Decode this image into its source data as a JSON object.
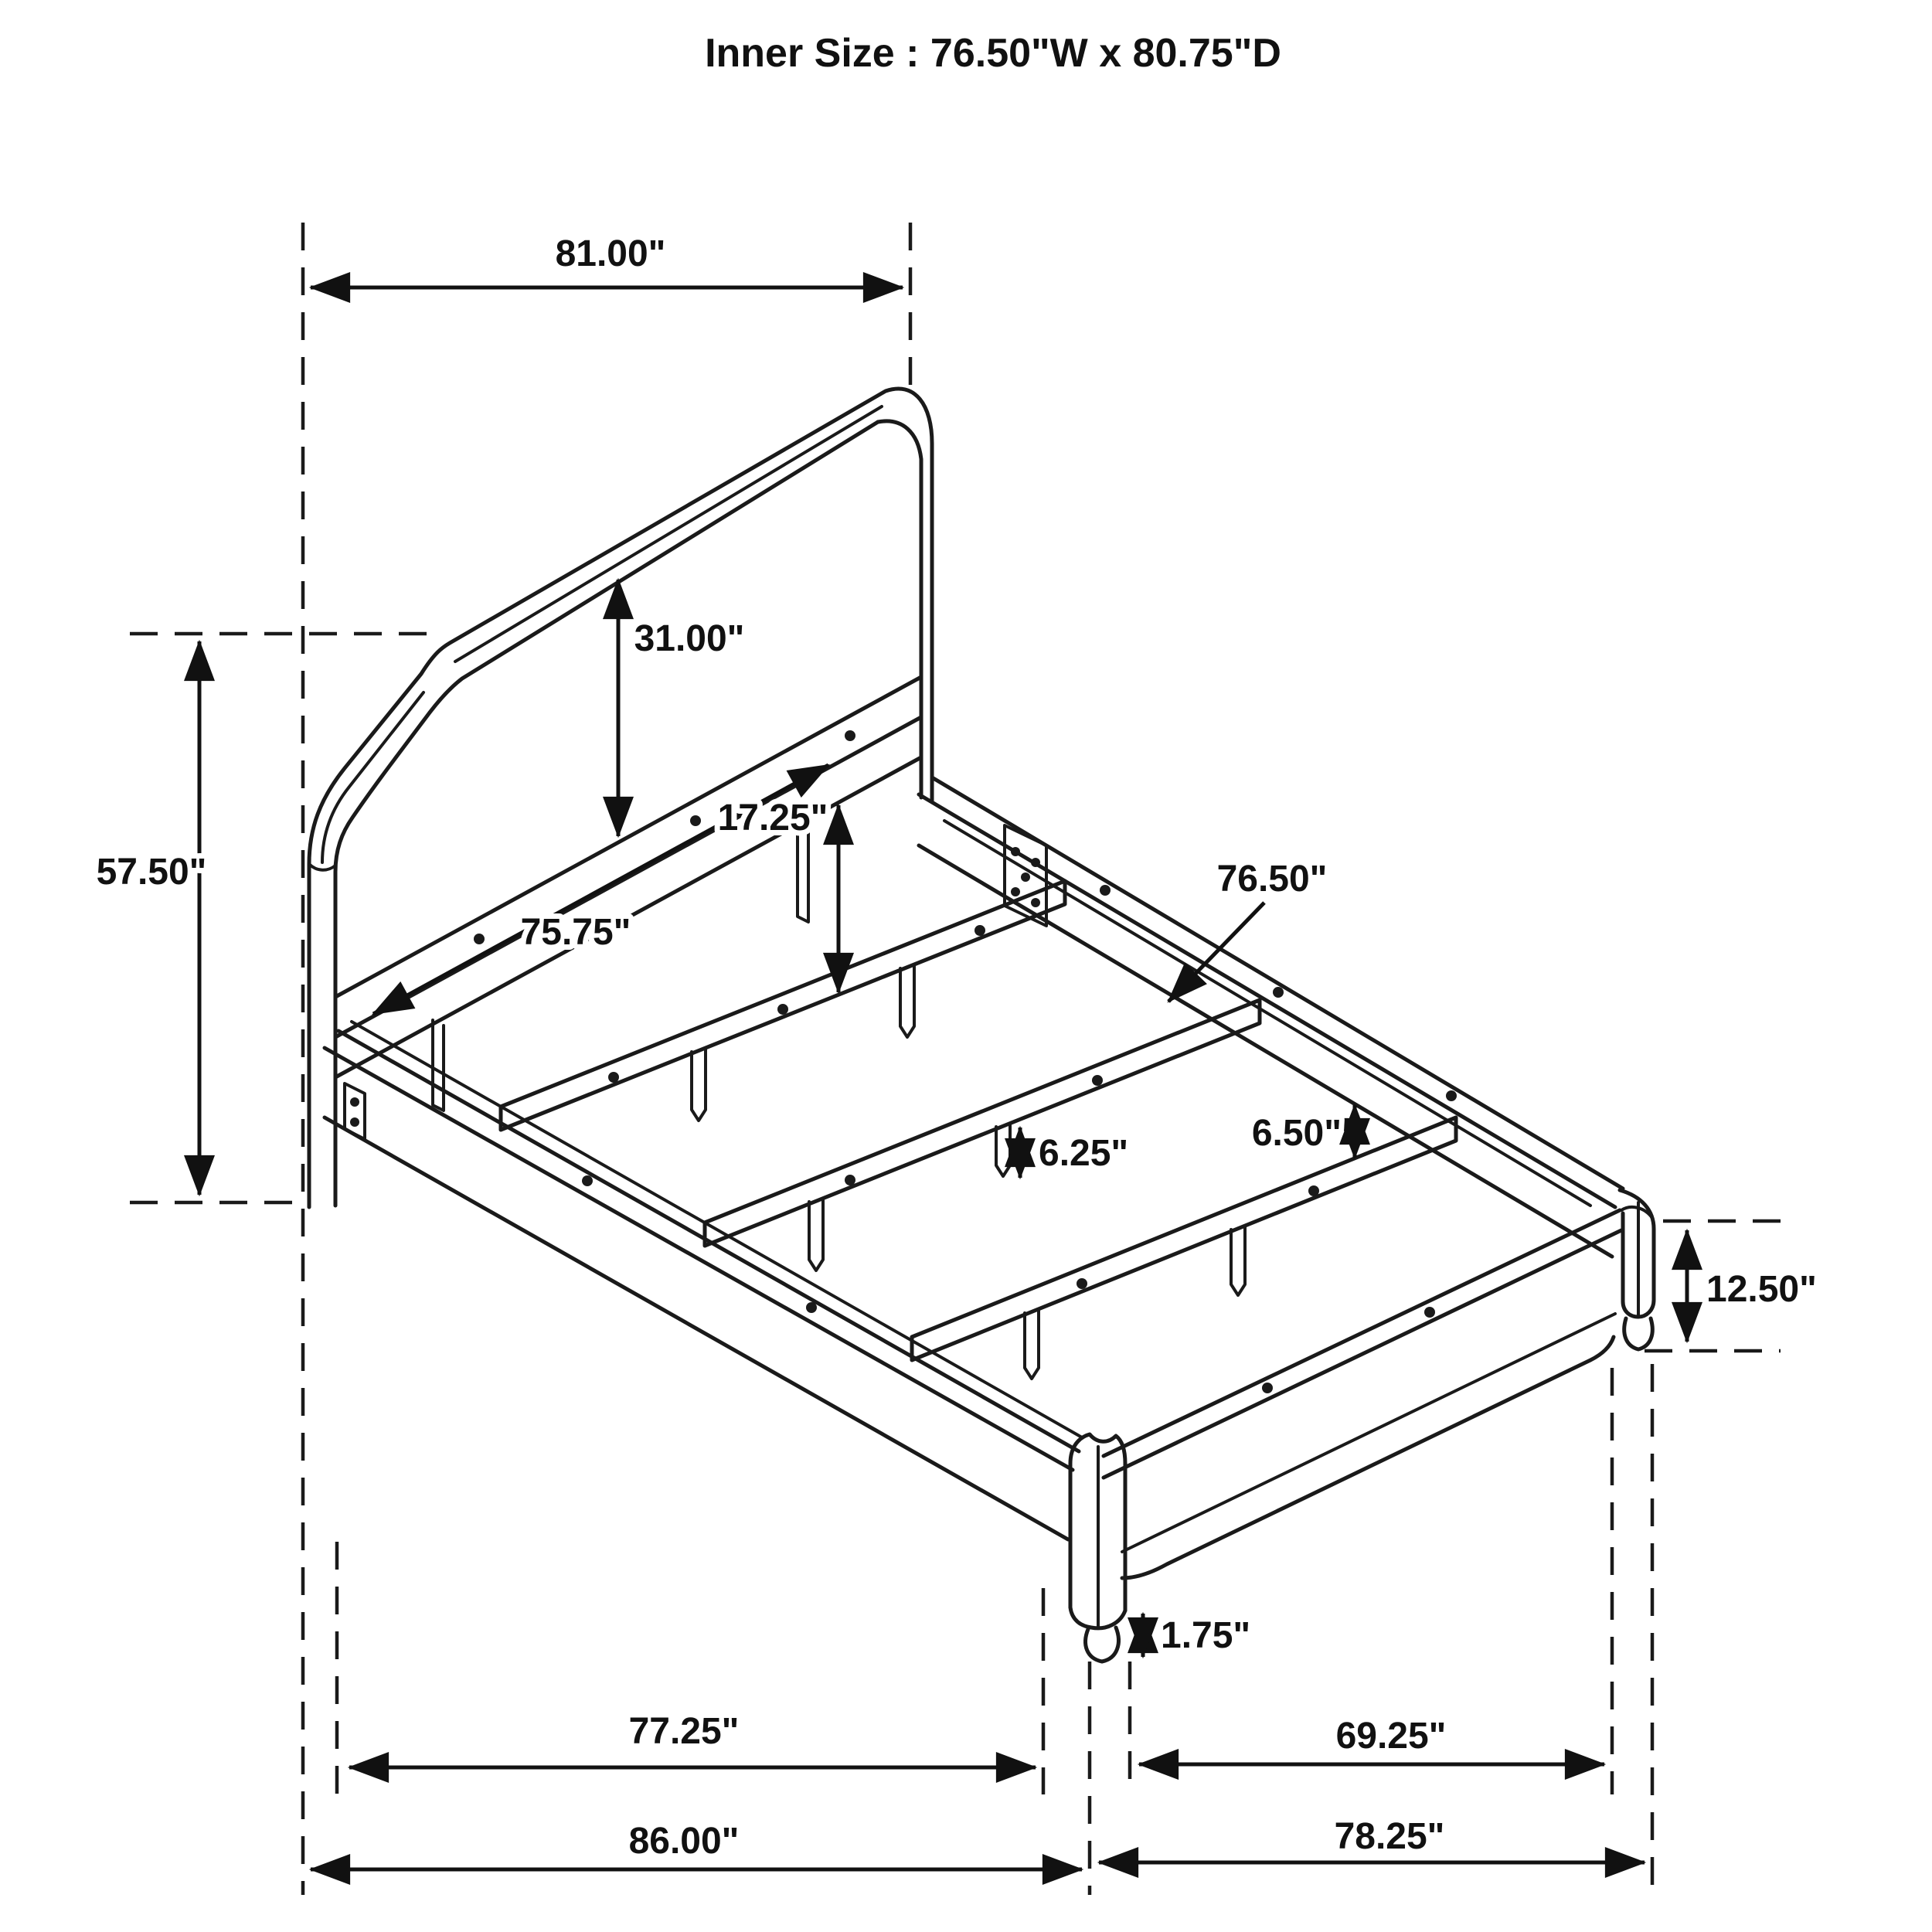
{
  "title": "Inner Size : 76.50\"W x 80.75\"D",
  "diagram": {
    "type": "furniture-dimension-diagram",
    "subject": "platform bed frame with headboard, slats and footboard",
    "labels": {
      "headboard_width": "81.00\"",
      "headboard_height": "57.50\"",
      "headboard_panel_height": "31.00\"",
      "headboard_clearance": "17.25\"",
      "headboard_inner_width": "75.75\"",
      "slat_length": "76.50\"",
      "rail_clearance": "6.50\"",
      "slat_leg_height": "6.25\"",
      "footboard_height": "12.50\"",
      "foot_height": "1.75\"",
      "inner_rail_length": "77.25\"",
      "foot_span": "69.25\"",
      "overall_depth": "86.00\"",
      "footboard_width": "78.25\""
    }
  }
}
